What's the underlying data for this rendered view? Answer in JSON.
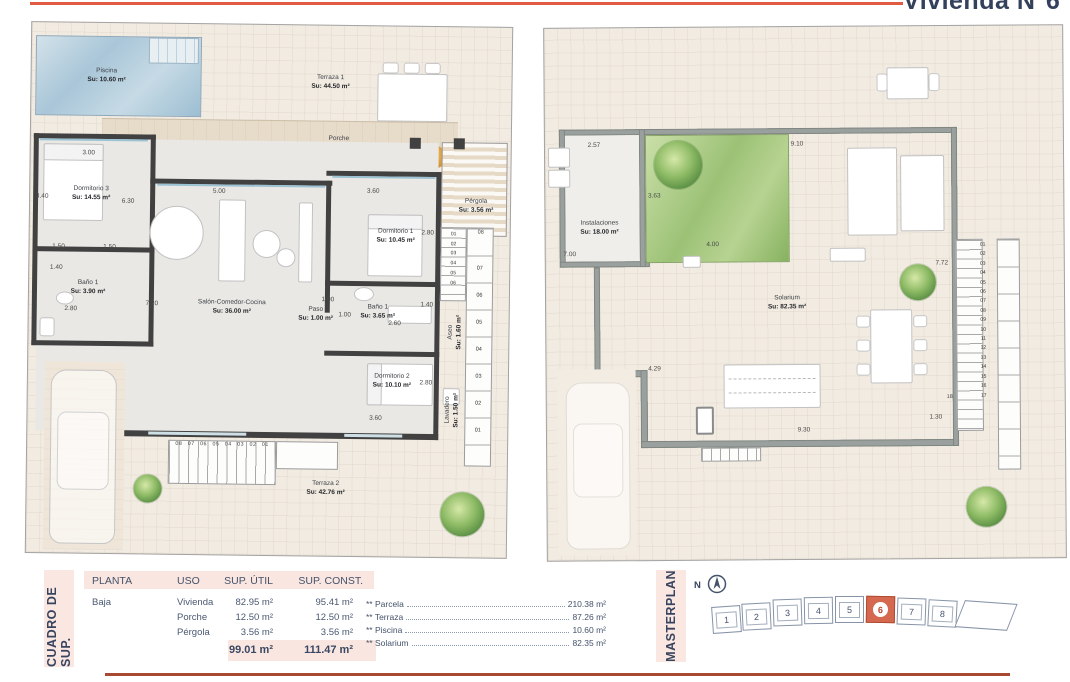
{
  "title": "Vivienda N°6",
  "colors": {
    "accent_top": "#e05b41",
    "accent_bottom": "#a84a31",
    "navy_text": "#37445f",
    "pink_band": "#fae6e0",
    "highlight_unit": "#d4694f"
  },
  "plans": {
    "left": {
      "rooms": {
        "piscina": {
          "name": "Piscina",
          "area": "Su: 10.60 m²"
        },
        "terraza1": {
          "name": "Terraza 1",
          "area": "Su: 44.50 m²"
        },
        "porche": {
          "name": "Porche",
          "area": "Su: 12.50 m²"
        },
        "dormitorio3": {
          "name": "Dormitorio 3",
          "area": "Su: 14.55 m²"
        },
        "bano1": {
          "name": "Baño 1",
          "area": "Su: 3.90 m²"
        },
        "salon": {
          "name": "Salón-Comedor-Cocina",
          "area": "Su: 36.00 m²"
        },
        "paso": {
          "name": "Paso",
          "area": "Su: 1.00 m²"
        },
        "dormitorio1": {
          "name": "Dormitorio 1",
          "area": "Su: 10.45 m²"
        },
        "bano2": {
          "name": "Baño 1",
          "area": "Su: 3.65 m²"
        },
        "dormitorio2": {
          "name": "Dormitorio 2",
          "area": "Su: 10.10 m²"
        },
        "aseo": {
          "name": "Aseo",
          "area": "Su: 1.60 m²"
        },
        "lavadero": {
          "name": "Lavadero",
          "area": "Su: 1.50 m²"
        },
        "pergola": {
          "name": "Pérgola",
          "area": "Su: 3.56 m²"
        },
        "terraza2": {
          "name": "Terraza 2",
          "area": "Su: 42.76 m²"
        }
      },
      "dims": {
        "d300": "3.00",
        "d340": "3.40",
        "d630": "6.30",
        "d500": "5.00",
        "d360a": "3.60",
        "d150a": "1.50",
        "d150b": "1.50",
        "d140a": "1.40",
        "d280a": "2.80",
        "d720": "7.20",
        "d280b": "2.80",
        "d100a": "1.00",
        "d100b": "1.00",
        "d140b": "1.40",
        "d260": "2.60",
        "d280c": "2.80",
        "d360b": "3.60"
      },
      "stairs": {
        "row": "08 07 06 05 04 03 02 01",
        "col_inner": "01\n02\n03\n04\n05\n06",
        "col_outer": "07\n06\n05\n04\n03\n02\n01",
        "top": "08"
      }
    },
    "right": {
      "rooms": {
        "instalaciones": {
          "name": "Instalaciones",
          "area": "Su: 18.00 m²"
        },
        "solarium": {
          "name": "Solarium",
          "area": "Su: 82.35 m²"
        }
      },
      "dims": {
        "d257": "2.57",
        "d910": "9.10",
        "d363": "3.63",
        "d700": "7.00",
        "d400": "4.00",
        "d772": "7.72",
        "d429": "4.29",
        "d930": "9.30",
        "d130": "1.30",
        "d18": "18"
      },
      "stairs": {
        "col": "01\n02\n03\n04\n05\n06\n07\n08\n09\n10\n11\n12\n13\n14\n15\n16\n17"
      }
    }
  },
  "table": {
    "section_label": "CUADRO DE SUP.",
    "headers": [
      "PLANTA",
      "USO",
      "SUP. ÚTIL",
      "SUP. CONST."
    ],
    "planta": "Baja",
    "rows": [
      {
        "uso": "Vivienda",
        "util": "82.95 m²",
        "const": "95.41 m²"
      },
      {
        "uso": "Porche",
        "util": "12.50 m²",
        "const": "12.50 m²"
      },
      {
        "uso": "Pérgola",
        "util": "3.56 m²",
        "const": "3.56 m²"
      }
    ],
    "totals": {
      "util": "99.01 m²",
      "const": "111.47 m²"
    },
    "extras": [
      {
        "label": "** Parcela",
        "value": "210.38 m²"
      },
      {
        "label": "** Terraza",
        "value": "87.26 m²"
      },
      {
        "label": "** Piscina",
        "value": "10.60 m²"
      },
      {
        "label": "** Solarium",
        "value": "82.35 m²"
      }
    ]
  },
  "masterplan": {
    "section_label": "MASTERPLAN",
    "north": "N",
    "units": [
      "1",
      "2",
      "3",
      "4",
      "5",
      "6",
      "7",
      "8"
    ],
    "highlighted": "6"
  }
}
